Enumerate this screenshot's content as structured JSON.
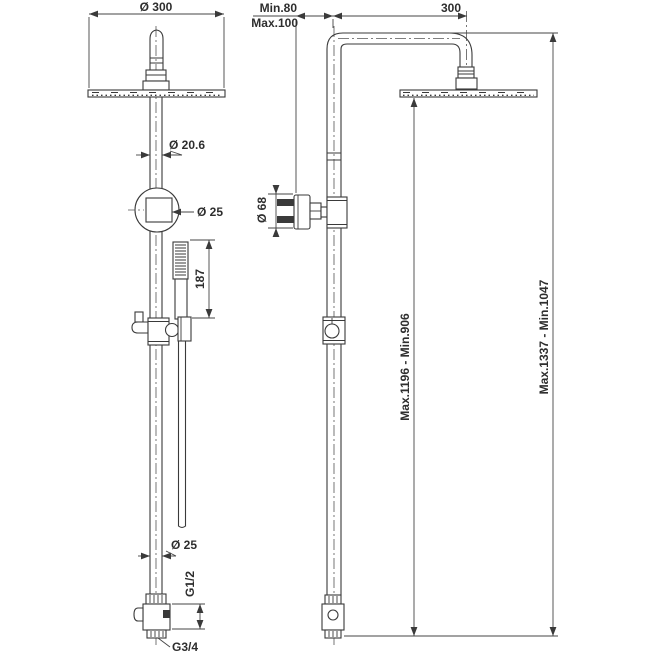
{
  "drawing": {
    "kind": "technical-dimension-drawing",
    "subject": "shower column with overhead rain shower and hand shower (front and side views)",
    "colors": {
      "line": "#3a3a3a",
      "background": "#ffffff"
    },
    "front_view": {
      "head_diameter": "Ø 300",
      "riser_diameter": "Ø 20.6",
      "slider_diameter": "Ø 25",
      "handshower_length": "187",
      "bottom_riser_diameter": "Ø 25",
      "inlet_thread": "G1/2",
      "outlet_thread": "G3/4"
    },
    "side_view": {
      "wall_distance_min": "Min.80",
      "wall_distance_max": "Max.100",
      "arm_projection": "300",
      "wall_flange_diameter": "Ø 68",
      "head_height_range": "Max.1196 - Min.906",
      "total_height_range": "Max.1337 - Min.1047"
    }
  }
}
